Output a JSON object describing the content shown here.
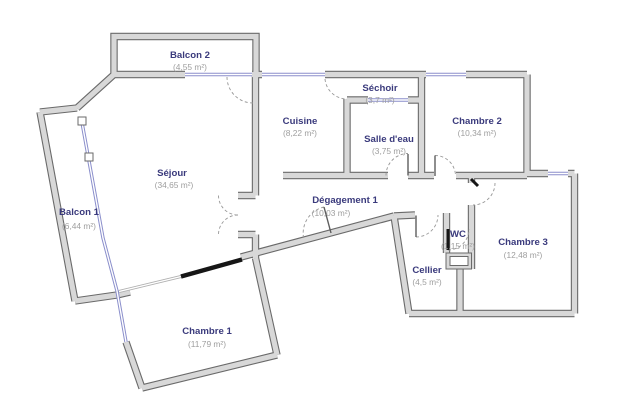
{
  "plan": {
    "type": "apartment-floor-plan",
    "colors": {
      "background": "#ffffff",
      "wall_fill": "#d8d8d8",
      "wall_edge": "#6a6a6a",
      "window": "#8a8ecb",
      "room_name": "#3a3a7c",
      "room_area": "#9e9e9e",
      "door_arc": "#979797",
      "door_black": "#161616"
    },
    "rooms": [
      {
        "id": "balcon-2",
        "name": "Balcon 2",
        "area": "(4,55 m²)"
      },
      {
        "id": "cuisine",
        "name": "Cuisine",
        "area": "(8,22 m²)"
      },
      {
        "id": "sechoir",
        "name": "Séchoir",
        "area": "(3,7 m²)"
      },
      {
        "id": "chambre-2",
        "name": "Chambre 2",
        "area": "(10,34 m²)"
      },
      {
        "id": "salle-deau",
        "name": "Salle d'eau",
        "area": "(3,75 m²)"
      },
      {
        "id": "sejour",
        "name": "Séjour",
        "area": "(34,65 m²)"
      },
      {
        "id": "balcon-1",
        "name": "Balcon 1",
        "area": "(6,44 m²)"
      },
      {
        "id": "degagement-1",
        "name": "Dégagement 1",
        "area": "(10,03 m²)"
      },
      {
        "id": "wc",
        "name": "WC",
        "area": "(1,15 m²)"
      },
      {
        "id": "chambre-3",
        "name": "Chambre 3",
        "area": "(12,48 m²)"
      },
      {
        "id": "cellier",
        "name": "Cellier",
        "area": "(4,5 m²)"
      },
      {
        "id": "chambre-1",
        "name": "Chambre 1",
        "area": "(11,79 m²)"
      }
    ]
  }
}
